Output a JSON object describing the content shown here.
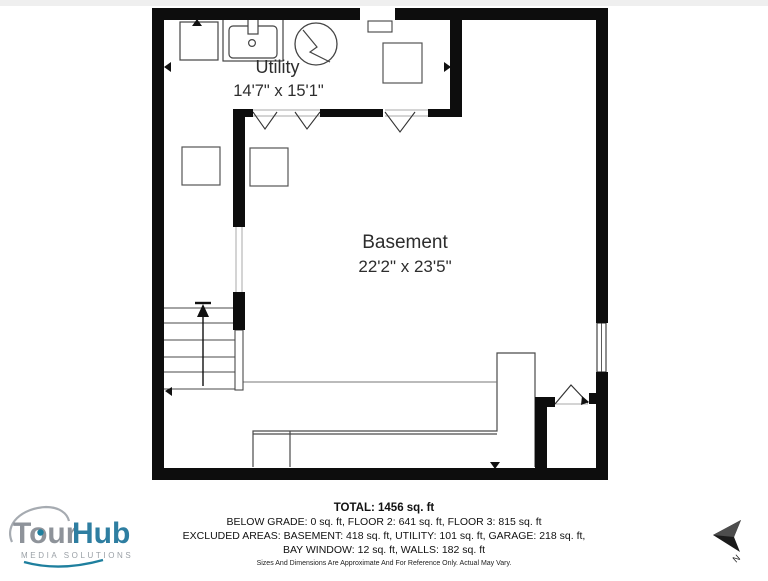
{
  "floorplan": {
    "rooms": [
      {
        "name": "Utility",
        "dimensions": "14'7\" x 15'1\""
      },
      {
        "name": "Basement",
        "dimensions": "22'2\" x 23'5\""
      }
    ],
    "compass": {
      "label": "N"
    },
    "wall_color": "#0d0d0d"
  },
  "footer": {
    "total": "TOTAL: 1456 sq. ft",
    "line2": "BELOW GRADE: 0 sq. ft, FLOOR 2: 641 sq. ft, FLOOR 3: 815 sq. ft",
    "line3": "EXCLUDED AREAS: BASEMENT: 418 sq. ft, UTILITY: 101 sq. ft, GARAGE: 218 sq. ft,",
    "line4": "BAY WINDOW: 12 sq. ft, WALLS: 182 sq. ft",
    "disclaimer": "Sizes And Dimensions Are Approximate And For Reference Only. Actual May Vary."
  },
  "logo": {
    "brand_part1": "Tour",
    "brand_part2": "Hub",
    "tagline": "MEDIA SOLUTIONS",
    "brand_gray": "#8e939a",
    "brand_blue": "#2e7ea1",
    "accent_teal": "#1e7f9e"
  }
}
